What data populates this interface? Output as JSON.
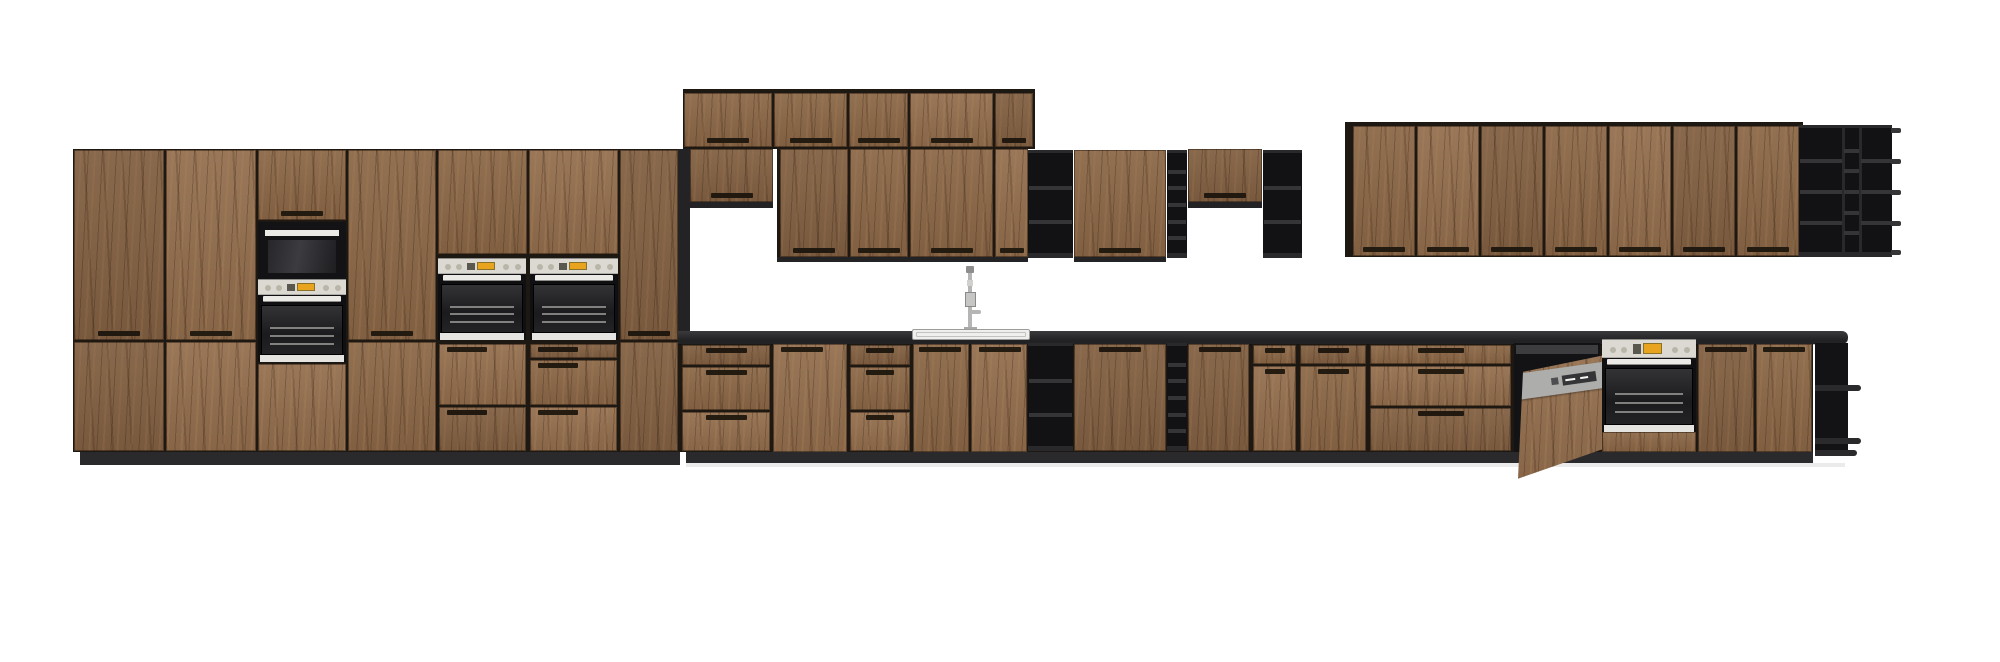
{
  "meta": {
    "width": 2000,
    "height": 662,
    "background": "#ffffff",
    "scene": "kitchen-elevation-render"
  },
  "palette": {
    "carcass": "#1e1812",
    "panel": "#232325",
    "plinth": "#2a2a2c",
    "shelfBg": "#121214",
    "shelfFrame": "#29292b",
    "shelfFace": "#353537",
    "counter": "#29292b",
    "steel": "#dcd9d2",
    "display": "#e8a31f",
    "dwGray": "#a3a3a1",
    "wood": "#8b6747",
    "glass": "#1f1f21",
    "trimWhite": "#eceae6"
  },
  "objects": [
    {
      "t": "dark",
      "n": "tall-run-carcass",
      "x": 73,
      "y": 149,
      "w": 607,
      "h": 303,
      "c": "carcass"
    },
    {
      "t": "dark",
      "n": "tall-run-side-panel",
      "x": 678,
      "y": 149,
      "w": 12,
      "h": 194,
      "c": "panel"
    },
    {
      "t": "dark",
      "n": "upper-top-row-carcass",
      "x": 683,
      "y": 89,
      "w": 352,
      "h": 60,
      "c": "carcass"
    },
    {
      "t": "dark",
      "n": "upper-row-carcass",
      "x": 777,
      "y": 148,
      "w": 251,
      "h": 114,
      "c": "carcass"
    },
    {
      "t": "dark",
      "n": "upper-right-run-carcass",
      "x": 1345,
      "y": 122,
      "w": 458,
      "h": 135,
      "c": "carcass"
    },
    {
      "t": "dark",
      "n": "base-run-carcass",
      "x": 680,
      "y": 343,
      "w": 1133,
      "h": 109,
      "c": "carcass"
    },
    {
      "t": "dark",
      "n": "toe-kick-left",
      "x": 80,
      "y": 452,
      "w": 600,
      "h": 13,
      "c": "plinth"
    },
    {
      "t": "dark",
      "n": "toe-kick-right",
      "x": 686,
      "y": 452,
      "w": 1127,
      "h": 11,
      "c": "plinth"
    },
    {
      "t": "dark",
      "n": "floor-shadow",
      "x": 686,
      "y": 463,
      "w": 1159,
      "h": 4,
      "c": "#ebebeb"
    },
    {
      "t": "door",
      "n": "pantry-door",
      "x": 74,
      "y": 150,
      "w": 90,
      "h": 190,
      "handle": "bc"
    },
    {
      "t": "door",
      "n": "pantry-door-lower",
      "x": 74,
      "y": 342,
      "w": 90,
      "h": 109
    },
    {
      "t": "door",
      "n": "pantry-door",
      "x": 166,
      "y": 150,
      "w": 90,
      "h": 190,
      "handle": "bc"
    },
    {
      "t": "door",
      "n": "pantry-door-lower",
      "x": 166,
      "y": 342,
      "w": 90,
      "h": 109
    },
    {
      "t": "door",
      "n": "appliance-column-top-door",
      "x": 258,
      "y": 150,
      "w": 88,
      "h": 70,
      "handle": "bc"
    },
    {
      "t": "microwave",
      "n": "built-in-compact-oven",
      "x": 258,
      "y": 222,
      "w": 88,
      "h": 57
    },
    {
      "t": "controlStrip",
      "n": "compact-oven-control-panel",
      "x": 258,
      "y": 279,
      "w": 88,
      "h": 16
    },
    {
      "t": "ovenBody",
      "n": "built-in-oven-upper",
      "x": 258,
      "y": 295,
      "w": 88,
      "h": 67
    },
    {
      "t": "door",
      "n": "appliance-column-bottom-door",
      "x": 258,
      "y": 364,
      "w": 88,
      "h": 87
    },
    {
      "t": "door",
      "n": "pantry-door",
      "x": 348,
      "y": 150,
      "w": 88,
      "h": 190,
      "handle": "bc"
    },
    {
      "t": "door",
      "n": "pantry-door-lower",
      "x": 348,
      "y": 342,
      "w": 88,
      "h": 109
    },
    {
      "t": "door",
      "n": "oven-column-top-door",
      "x": 438,
      "y": 150,
      "w": 89,
      "h": 104
    },
    {
      "t": "controlStrip",
      "n": "wall-oven-control-panel",
      "x": 438,
      "y": 258,
      "w": 88,
      "h": 16
    },
    {
      "t": "ovenBody",
      "n": "wall-oven-left",
      "x": 438,
      "y": 274,
      "w": 88,
      "h": 66
    },
    {
      "t": "drawerStack",
      "n": "oven-base-drawers",
      "x": 438,
      "y": 343,
      "w": 89,
      "h": 109,
      "splits": [
        0.58
      ],
      "hpos": "tl"
    },
    {
      "t": "door",
      "n": "oven-column-top-door",
      "x": 529,
      "y": 150,
      "w": 89,
      "h": 104
    },
    {
      "t": "controlStrip",
      "n": "wall-oven-control-panel",
      "x": 530,
      "y": 258,
      "w": 88,
      "h": 16
    },
    {
      "t": "ovenBody",
      "n": "wall-oven-right",
      "x": 530,
      "y": 274,
      "w": 88,
      "h": 66
    },
    {
      "t": "drawerStack",
      "n": "oven-base-drawers",
      "x": 529,
      "y": 343,
      "w": 89,
      "h": 109,
      "splits": [
        0.15,
        0.58
      ],
      "hpos": "tl"
    },
    {
      "t": "door",
      "n": "pantry-door",
      "x": 620,
      "y": 150,
      "w": 58,
      "h": 190,
      "handle": "bc"
    },
    {
      "t": "door",
      "n": "pantry-door-lower",
      "x": 620,
      "y": 342,
      "w": 58,
      "h": 109
    },
    {
      "t": "door",
      "n": "upper-cabinet-door",
      "x": 684,
      "y": 93,
      "w": 88,
      "h": 54,
      "handle": "bc"
    },
    {
      "t": "door",
      "n": "upper-cabinet-door",
      "x": 774,
      "y": 93,
      "w": 73,
      "h": 54,
      "handle": "bc"
    },
    {
      "t": "door",
      "n": "upper-cabinet-door",
      "x": 849,
      "y": 93,
      "w": 59,
      "h": 54,
      "handle": "bc"
    },
    {
      "t": "door",
      "n": "upper-cabinet-door",
      "x": 910,
      "y": 93,
      "w": 83,
      "h": 54,
      "handle": "bc"
    },
    {
      "t": "door",
      "n": "upper-cabinet-door",
      "x": 995,
      "y": 93,
      "w": 38,
      "h": 54,
      "handle": "bc"
    },
    {
      "t": "door",
      "n": "upper-cabinet-door-short",
      "x": 690,
      "y": 149,
      "w": 83,
      "h": 53,
      "handle": "bc"
    },
    {
      "t": "dark",
      "n": "cabinet-bottom-edge",
      "x": 690,
      "y": 202,
      "w": 83,
      "h": 6,
      "c": "panel"
    },
    {
      "t": "door",
      "n": "upper-cabinet-door",
      "x": 780,
      "y": 149,
      "w": 68,
      "h": 108,
      "handle": "bc"
    },
    {
      "t": "door",
      "n": "upper-cabinet-door",
      "x": 850,
      "y": 149,
      "w": 58,
      "h": 108,
      "handle": "bc"
    },
    {
      "t": "door",
      "n": "upper-cabinet-door",
      "x": 910,
      "y": 149,
      "w": 83,
      "h": 108,
      "handle": "bc"
    },
    {
      "t": "door",
      "n": "upper-cabinet-door",
      "x": 995,
      "y": 149,
      "w": 33,
      "h": 108,
      "handle": "bc"
    },
    {
      "t": "dark",
      "n": "cabinet-bottom-edge",
      "x": 777,
      "y": 257,
      "w": 251,
      "h": 5,
      "c": "panel"
    },
    {
      "t": "shelf",
      "n": "open-shelf-unit",
      "x": 1028,
      "y": 150,
      "w": 45,
      "h": 108,
      "cols": [
        {
          "w": 45,
          "cells": 3
        }
      ]
    },
    {
      "t": "door",
      "n": "upper-cabinet-door",
      "x": 1074,
      "y": 150,
      "w": 92,
      "h": 107,
      "handle": "bc"
    },
    {
      "t": "dark",
      "n": "cabinet-bottom-edge",
      "x": 1074,
      "y": 257,
      "w": 92,
      "h": 5,
      "c": "panel"
    },
    {
      "t": "shelf",
      "n": "wine-shelf-column",
      "x": 1167,
      "y": 150,
      "w": 20,
      "h": 108,
      "cols": [
        {
          "w": 20,
          "cells": 6
        }
      ]
    },
    {
      "t": "door",
      "n": "upper-cabinet-door-short",
      "x": 1188,
      "y": 149,
      "w": 74,
      "h": 53,
      "handle": "bc"
    },
    {
      "t": "dark",
      "n": "cabinet-bottom-edge",
      "x": 1188,
      "y": 202,
      "w": 74,
      "h": 6,
      "c": "panel"
    },
    {
      "t": "shelf",
      "n": "open-shelf-unit",
      "x": 1263,
      "y": 150,
      "w": 39,
      "h": 108,
      "cols": [
        {
          "w": 39,
          "cells": 3
        }
      ]
    },
    {
      "t": "door",
      "n": "upper-cabinet-door",
      "x": 1353,
      "y": 126,
      "w": 62,
      "h": 130,
      "handle": "bc"
    },
    {
      "t": "door",
      "n": "upper-cabinet-door",
      "x": 1417,
      "y": 126,
      "w": 62,
      "h": 130,
      "handle": "bc"
    },
    {
      "t": "door",
      "n": "upper-cabinet-door",
      "x": 1481,
      "y": 126,
      "w": 62,
      "h": 130,
      "handle": "bc"
    },
    {
      "t": "door",
      "n": "upper-cabinet-door",
      "x": 1545,
      "y": 126,
      "w": 62,
      "h": 130,
      "handle": "bc"
    },
    {
      "t": "door",
      "n": "upper-cabinet-door",
      "x": 1609,
      "y": 126,
      "w": 62,
      "h": 130,
      "handle": "bc"
    },
    {
      "t": "door",
      "n": "upper-cabinet-door",
      "x": 1673,
      "y": 126,
      "w": 62,
      "h": 130,
      "handle": "bc"
    },
    {
      "t": "door",
      "n": "upper-cabinet-door",
      "x": 1737,
      "y": 126,
      "w": 62,
      "h": 130,
      "handle": "bc"
    },
    {
      "t": "shelf",
      "n": "open-shelf-unit",
      "x": 1799,
      "y": 125,
      "w": 93,
      "h": 132,
      "cols": [
        {
          "w": 44,
          "cells": 4
        },
        {
          "w": 17,
          "cells": 6
        },
        {
          "w": 32,
          "cells": 4
        }
      ],
      "lips": true
    },
    {
      "t": "counter",
      "n": "countertop",
      "x": 678,
      "y": 331,
      "w": 1170,
      "h": 13
    },
    {
      "t": "faucet",
      "n": "faucet",
      "x": 958,
      "y": 266,
      "w": 26,
      "h": 66
    },
    {
      "t": "sink",
      "n": "sink-rim",
      "x": 912,
      "y": 329,
      "w": 118,
      "h": 11
    },
    {
      "t": "drawerStack",
      "n": "base-drawer-unit",
      "x": 681,
      "y": 344,
      "w": 90,
      "h": 108,
      "splits": [
        0.2,
        0.62
      ],
      "hpos": "tc"
    },
    {
      "t": "door",
      "n": "base-cabinet-door",
      "x": 773,
      "y": 344,
      "w": 74,
      "h": 108,
      "handle": "tl"
    },
    {
      "t": "drawerStack",
      "n": "base-drawer-unit",
      "x": 849,
      "y": 344,
      "w": 62,
      "h": 108,
      "splits": [
        0.2,
        0.62
      ],
      "hpos": "tc"
    },
    {
      "t": "door",
      "n": "sink-base-door",
      "x": 913,
      "y": 344,
      "w": 56,
      "h": 108,
      "handle": "tr"
    },
    {
      "t": "door",
      "n": "sink-base-door",
      "x": 971,
      "y": 344,
      "w": 56,
      "h": 108,
      "handle": "tl"
    },
    {
      "t": "shelf",
      "n": "open-shelf-unit",
      "x": 1028,
      "y": 343,
      "w": 45,
      "h": 108,
      "cols": [
        {
          "w": 45,
          "cells": 3
        }
      ]
    },
    {
      "t": "door",
      "n": "base-cabinet-door",
      "x": 1074,
      "y": 344,
      "w": 92,
      "h": 107,
      "handle": "tc"
    },
    {
      "t": "shelf",
      "n": "wine-shelf-column",
      "x": 1167,
      "y": 343,
      "w": 20,
      "h": 108,
      "cols": [
        {
          "w": 20,
          "cells": 6
        }
      ]
    },
    {
      "t": "door",
      "n": "base-cabinet-door",
      "x": 1188,
      "y": 344,
      "w": 61,
      "h": 107,
      "handle": "tr"
    },
    {
      "t": "drawerStack",
      "n": "drawer-over-door-unit",
      "x": 1252,
      "y": 344,
      "w": 45,
      "h": 108,
      "splits": [
        0.19
      ],
      "hpos": "tc"
    },
    {
      "t": "drawerStack",
      "n": "drawer-over-door-unit",
      "x": 1299,
      "y": 344,
      "w": 68,
      "h": 108,
      "splits": [
        0.19
      ],
      "hpos": "tc"
    },
    {
      "t": "drawerStack",
      "n": "base-drawer-unit",
      "x": 1369,
      "y": 344,
      "w": 143,
      "h": 108,
      "splits": [
        0.19,
        0.58
      ],
      "hpos": "tc"
    },
    {
      "t": "dishwasher",
      "n": "dishwasher-semi-integrated",
      "x": 1514,
      "y": 343,
      "w": 86,
      "h": 109
    },
    {
      "t": "controlStrip",
      "n": "oven-control-panel",
      "x": 1602,
      "y": 339,
      "w": 94,
      "h": 19
    },
    {
      "t": "ovenBody",
      "n": "built-in-oven",
      "x": 1602,
      "y": 358,
      "w": 94,
      "h": 74
    },
    {
      "t": "door",
      "n": "oven-base-filler",
      "x": 1602,
      "y": 432,
      "w": 94,
      "h": 20
    },
    {
      "t": "door",
      "n": "base-cabinet-door",
      "x": 1698,
      "y": 344,
      "w": 56,
      "h": 108,
      "handle": "tc"
    },
    {
      "t": "door",
      "n": "base-cabinet-door",
      "x": 1756,
      "y": 344,
      "w": 56,
      "h": 108,
      "handle": "tc"
    },
    {
      "t": "endShelf",
      "n": "open-end-shelf",
      "x": 1815,
      "y": 343,
      "w": 33,
      "h": 113
    }
  ]
}
